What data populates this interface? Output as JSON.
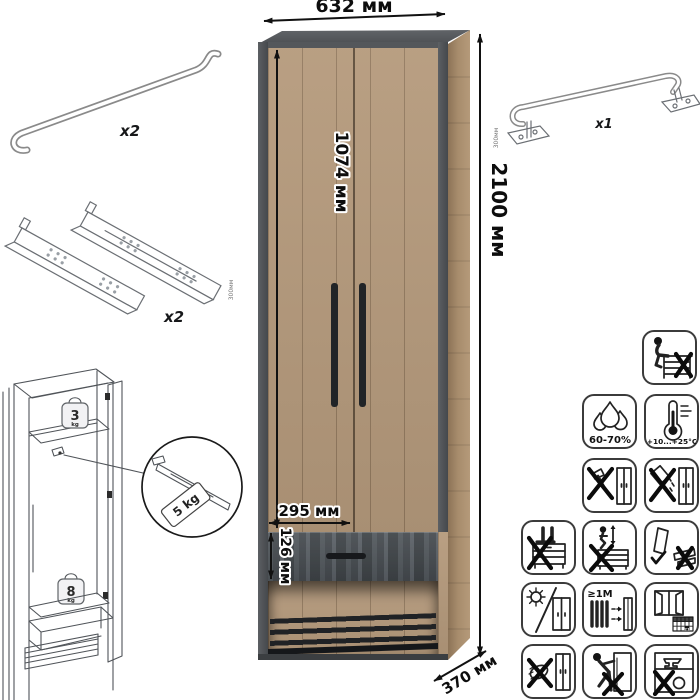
{
  "dimensions": {
    "overall_width": "632 мм",
    "overall_height": "2100 мм",
    "door_height": "1074 мм",
    "niche_width": "295 мм",
    "drawer_height": "126 мм",
    "overall_depth": "370 мм"
  },
  "accessories": {
    "handle_rails_qty": "x2",
    "drawer_slides_qty": "x2",
    "drawer_slides_size": "300мм",
    "hanging_rail_qty": "x1",
    "hanging_rail_size": "300мм"
  },
  "load_limits": {
    "top_shelf_value": "3",
    "top_shelf_unit": "kg",
    "hanging_rail": "5 kg",
    "drawer_shelf_value": "8",
    "drawer_shelf_unit": "kg"
  },
  "care": {
    "humidity": "60-70%",
    "temperature": "+10...+25°C",
    "min_distance": "≥1М",
    "calendar_day": "21"
  },
  "colors": {
    "wood": "#b2977a",
    "frame_dark": "#54575b",
    "drawer_front": "#4d5357",
    "handles": "#1f2225",
    "background": "#ffffff"
  }
}
